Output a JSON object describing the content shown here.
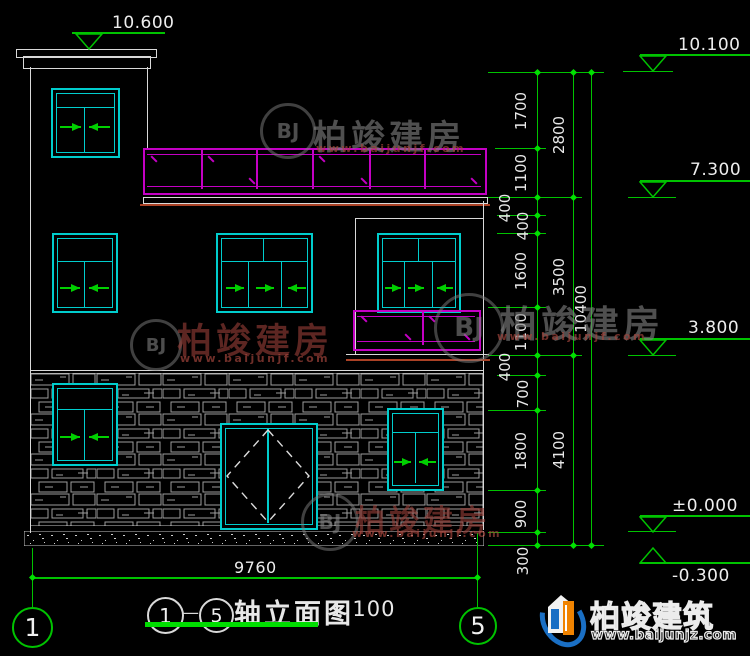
{
  "drawing": {
    "title_axis_start": "1",
    "title_axis_end": "5",
    "title_dash": "—",
    "title_name": "轴立面图",
    "title_scale": "1:100"
  },
  "levels": {
    "tower_top": "10.600",
    "roof": "10.100",
    "terrace": "7.300",
    "floor2": "3.800",
    "ground": "±0.000",
    "base": "-0.300"
  },
  "dims": {
    "inner": [
      "1700",
      "1100",
      "400",
      "400",
      "1600",
      "1100",
      "400",
      "700",
      "1800",
      "900",
      "300"
    ],
    "mid": [
      "2800",
      "3500",
      "4100"
    ],
    "total": "10400",
    "bottom": "9760"
  },
  "axes": {
    "left": "1",
    "right": "5"
  },
  "watermark": {
    "monogram": "BJ",
    "text": "柏竣建房",
    "url": "www.baijunjf.com"
  },
  "brand": {
    "name": "柏竣建筑",
    "url": "www.baijunjz.com"
  },
  "colors": {
    "line_white": "#d9d9d9",
    "dim_green": "#00c300",
    "window_cyan": "#00cdcd",
    "railing_magenta": "#c400c4",
    "sill_red": "#ab4226",
    "brand_blue": "#1a6fc4",
    "brand_orange": "#f08300"
  }
}
